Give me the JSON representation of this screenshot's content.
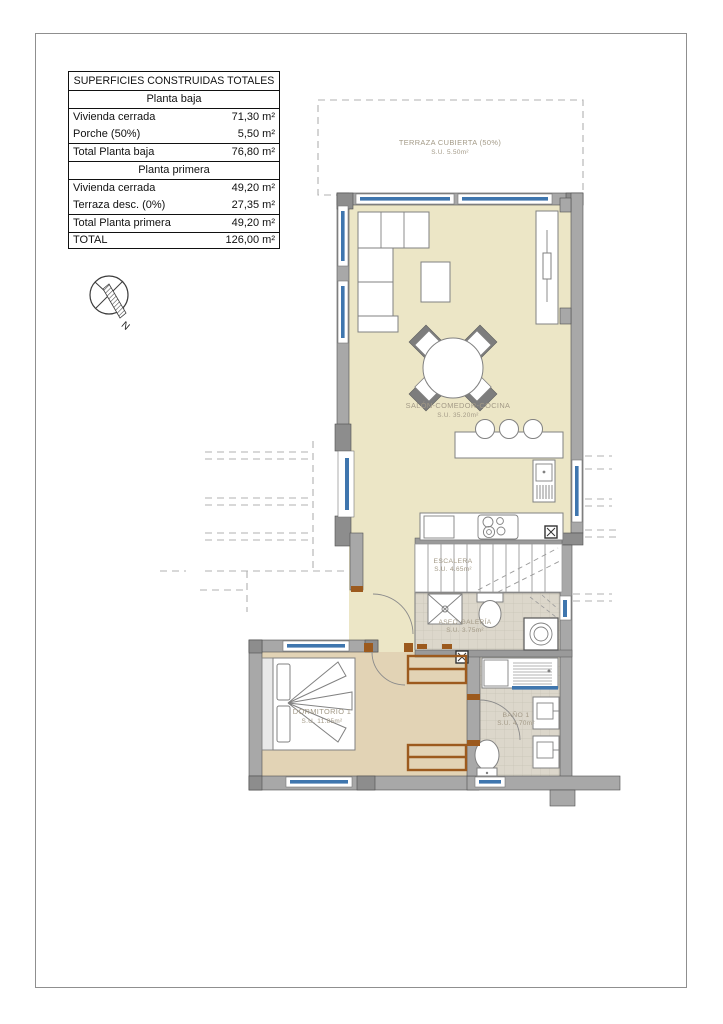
{
  "table": {
    "title": "SUPERFICIES CONSTRUIDAS TOTALES",
    "sections": [
      {
        "header": "Planta baja",
        "rows": [
          {
            "label": "Vivienda cerrada",
            "value": "71,30 m²"
          },
          {
            "label": "Porche (50%)",
            "value": "5,50 m²"
          }
        ],
        "total": {
          "label": "Total Planta baja",
          "value": "76,80 m²"
        }
      },
      {
        "header": "Planta primera",
        "rows": [
          {
            "label": "Vivienda cerrada",
            "value": "49,20 m²"
          },
          {
            "label": "Terraza desc. (0%)",
            "value": "27,35 m²"
          }
        ],
        "total": {
          "label": "Total Planta primera",
          "value": "49,20 m²"
        }
      }
    ],
    "grand_total": {
      "label": "TOTAL",
      "value": "126,00 m²"
    }
  },
  "compass": {
    "north_label": "N"
  },
  "rooms": {
    "terraza": {
      "name": "TERRAZA CUBIERTA (50%)",
      "area": "S.U. 5.50m²"
    },
    "salon": {
      "name": "SALÓN-COMEDOR-COCINA",
      "area": "S.U. 35.20m²"
    },
    "escalera": {
      "name": "ESCALERA",
      "area": "S.U. 4.65m²"
    },
    "aseo": {
      "name": "ASEO-GALERÍA",
      "area": "S.U. 3.75m²"
    },
    "dormitorio": {
      "name": "DORMITORIO 1",
      "area": "S.U. 11.85m²"
    },
    "bano": {
      "name": "BAÑO 1",
      "area": "S.U. 4.70m²"
    }
  },
  "colors": {
    "floor_main": "#ece6c6",
    "floor_bedroom": "#e2d3b5",
    "floor_tile": "#dcd7cb",
    "wall": "#a8a8a8",
    "window_glass": "#3f76ae",
    "door_wood": "#9c5a1e"
  }
}
